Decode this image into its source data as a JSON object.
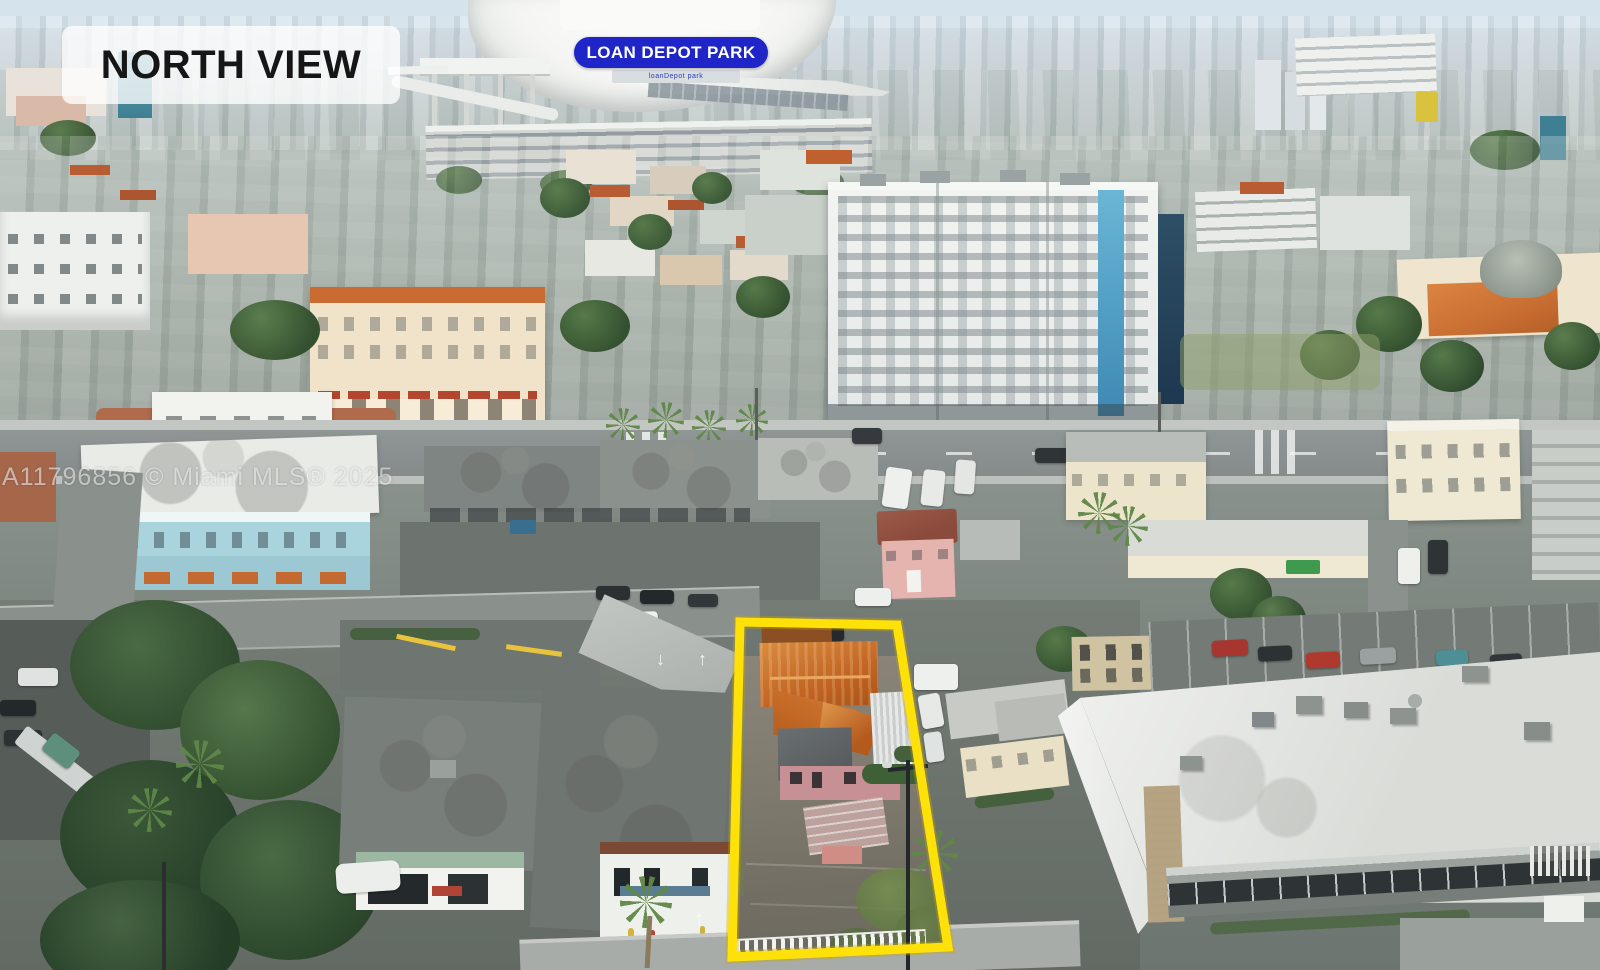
{
  "overlays": {
    "view_badge": {
      "label": "NORTH VIEW",
      "bg": "rgba(255,255,255,0.78)",
      "color": "#161616"
    },
    "stadium_badge": {
      "label": "LOAN DEPOT PARK",
      "bg": "#2025C8",
      "color": "#FFFFFF"
    },
    "watermark": {
      "text": "A11796856 © Miami MLS® 2025",
      "color": "rgba(255,255,255,0.55)"
    }
  },
  "scene": {
    "stadium_sign": "loanDepot park",
    "highlight": {
      "outline_color": "#FFE10A"
    },
    "road_arrow_up": "↑",
    "road_arrow_down": "↓"
  }
}
